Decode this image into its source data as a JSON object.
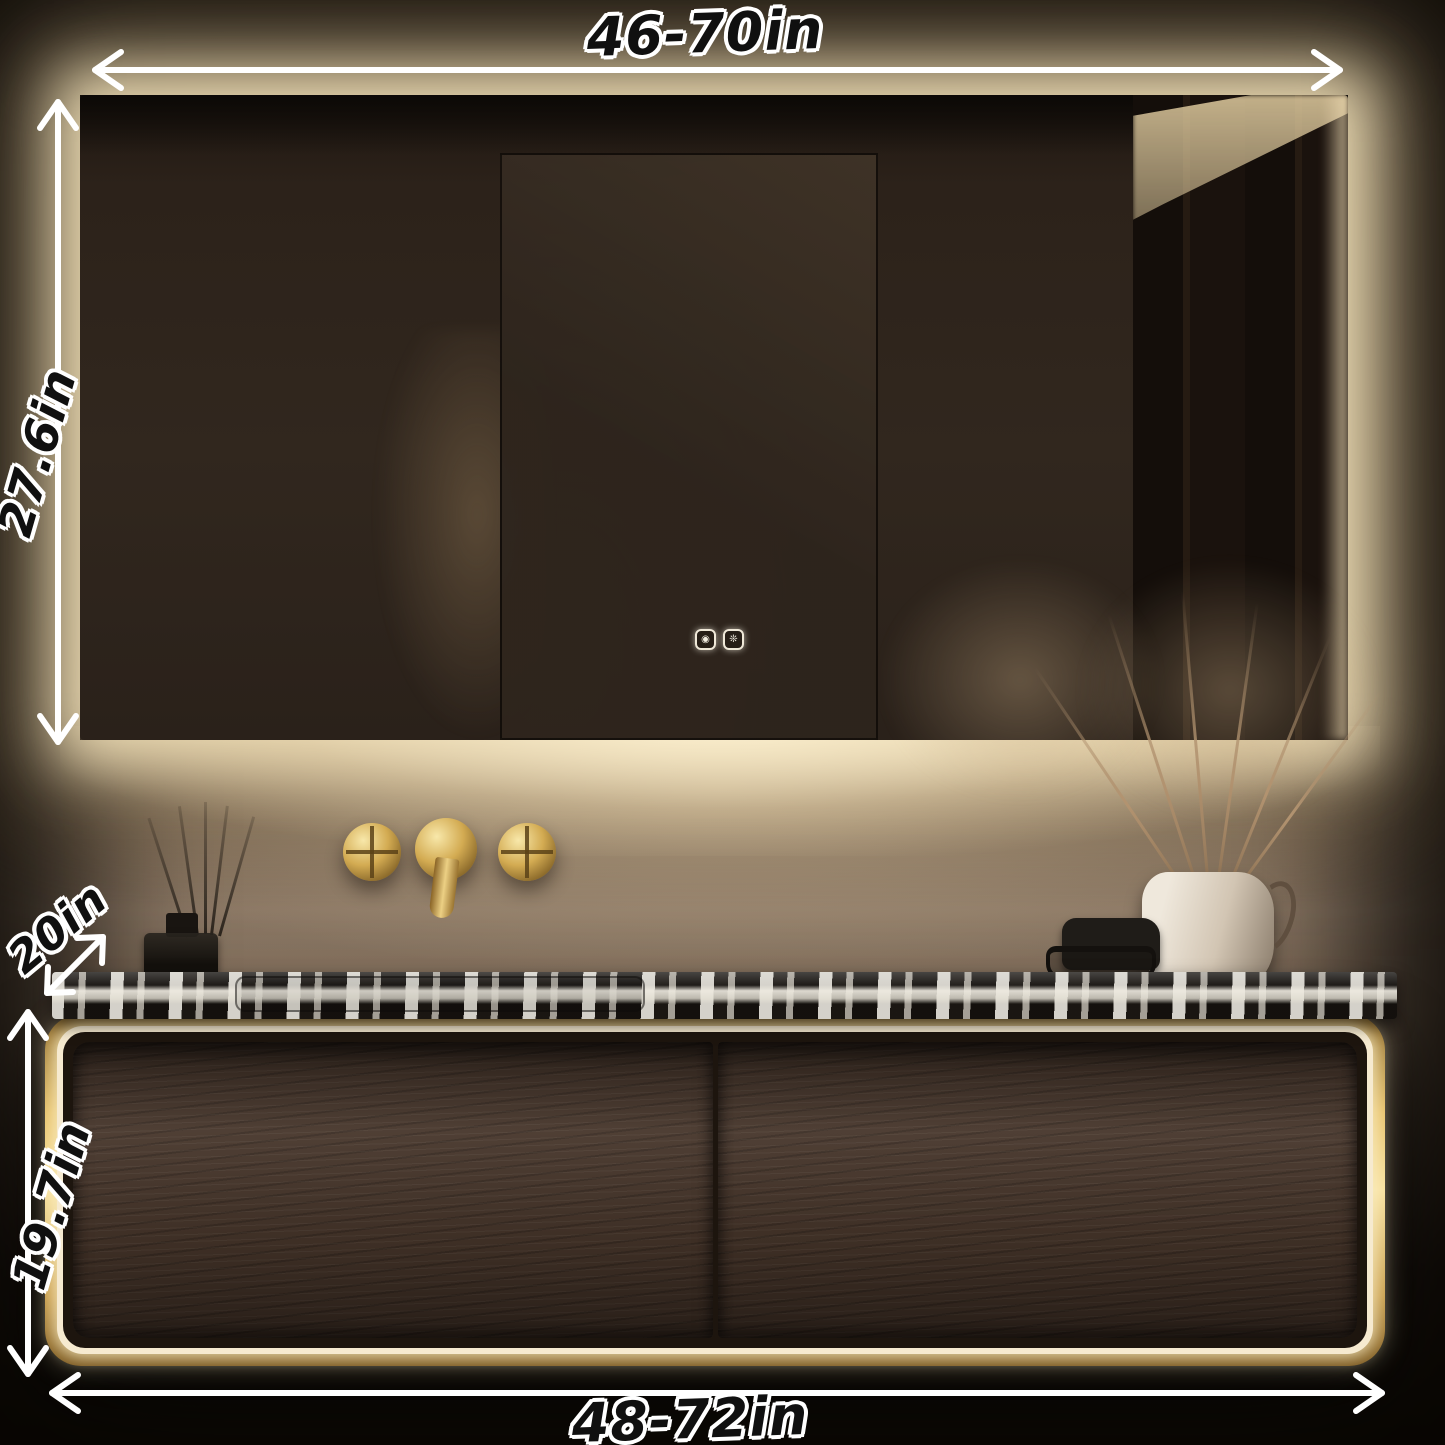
{
  "dimension_labels": {
    "mirror_width": "46-70in",
    "mirror_height": "27.6in",
    "counter_depth": "20in",
    "cabinet_height": "19.7in",
    "cabinet_width": "48-72in"
  },
  "mirror": {
    "touch_buttons": [
      {
        "name": "light-button-icon",
        "glyph": "◉"
      },
      {
        "name": "defog-button-icon",
        "glyph": "❊"
      }
    ]
  },
  "colors": {
    "arrow": "#ffffff",
    "label_fill": "#101010",
    "label_outline": "#ffffff",
    "led_glow": "#f6ead0",
    "gold_frame": "#e6c169",
    "drawer_wood": "#46352a",
    "counter_base": "#24201b",
    "counter_vein": "#eae6dc",
    "faucet_gold": "#d3ab52",
    "wall_lit": "#8d7a69",
    "wall_dark": "#1b140f"
  }
}
